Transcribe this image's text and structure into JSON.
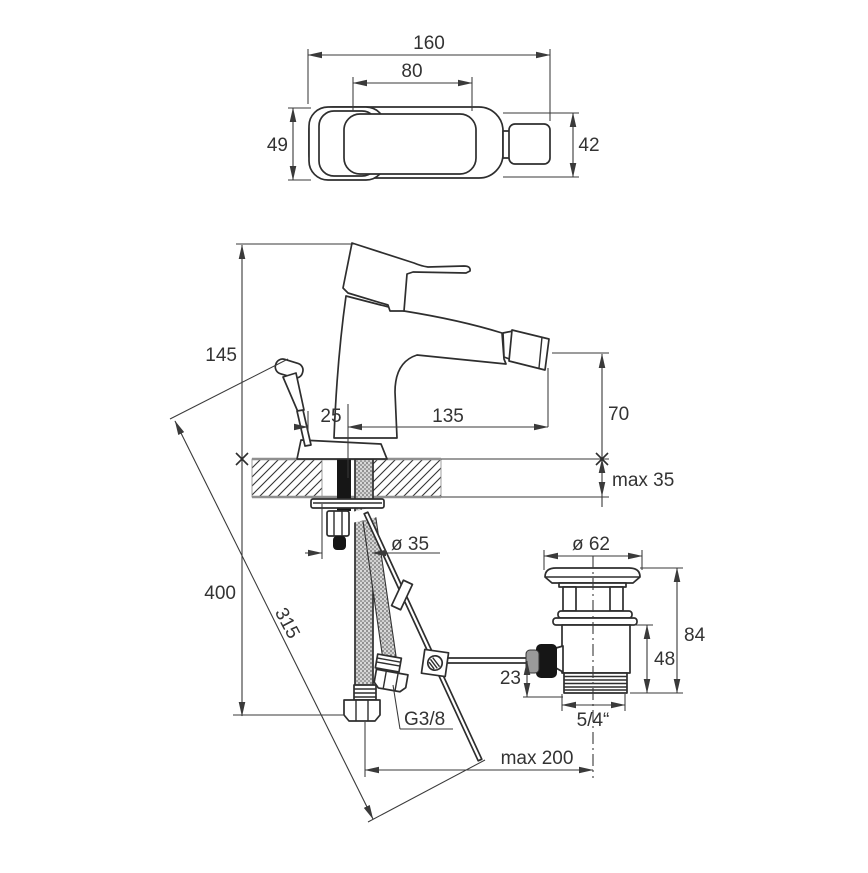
{
  "meta": {
    "type": "technical-drawing",
    "subject": "bidet mixer with pop-up waste - installation dimensions"
  },
  "colors": {
    "line": "#2e2e2e",
    "dimension_line": "#3a3a3a",
    "text": "#333333",
    "deck_edge": "#8f8f8f",
    "black_part": "#161616",
    "grey_part": "#9a9a9a"
  },
  "top_view": {
    "overall_length": "160",
    "lever_length": "80",
    "body_width": "49",
    "end_height": "42"
  },
  "front_view": {
    "total_height": "145",
    "rod_offset": "25",
    "spout_reach": "135",
    "outlet_height": "70",
    "deck_thickness": "max 35",
    "hole_diameter": "ø 35",
    "hose_drop": "400",
    "rod_length": "315"
  },
  "waste": {
    "cap_diameter": "ø 62",
    "overall_height": "84",
    "body_height": "48",
    "outlet_offset": "23",
    "thread_size": "5/4“",
    "horizontal_reach": "max 200"
  },
  "supply": {
    "hose_thread": "G3/8"
  }
}
